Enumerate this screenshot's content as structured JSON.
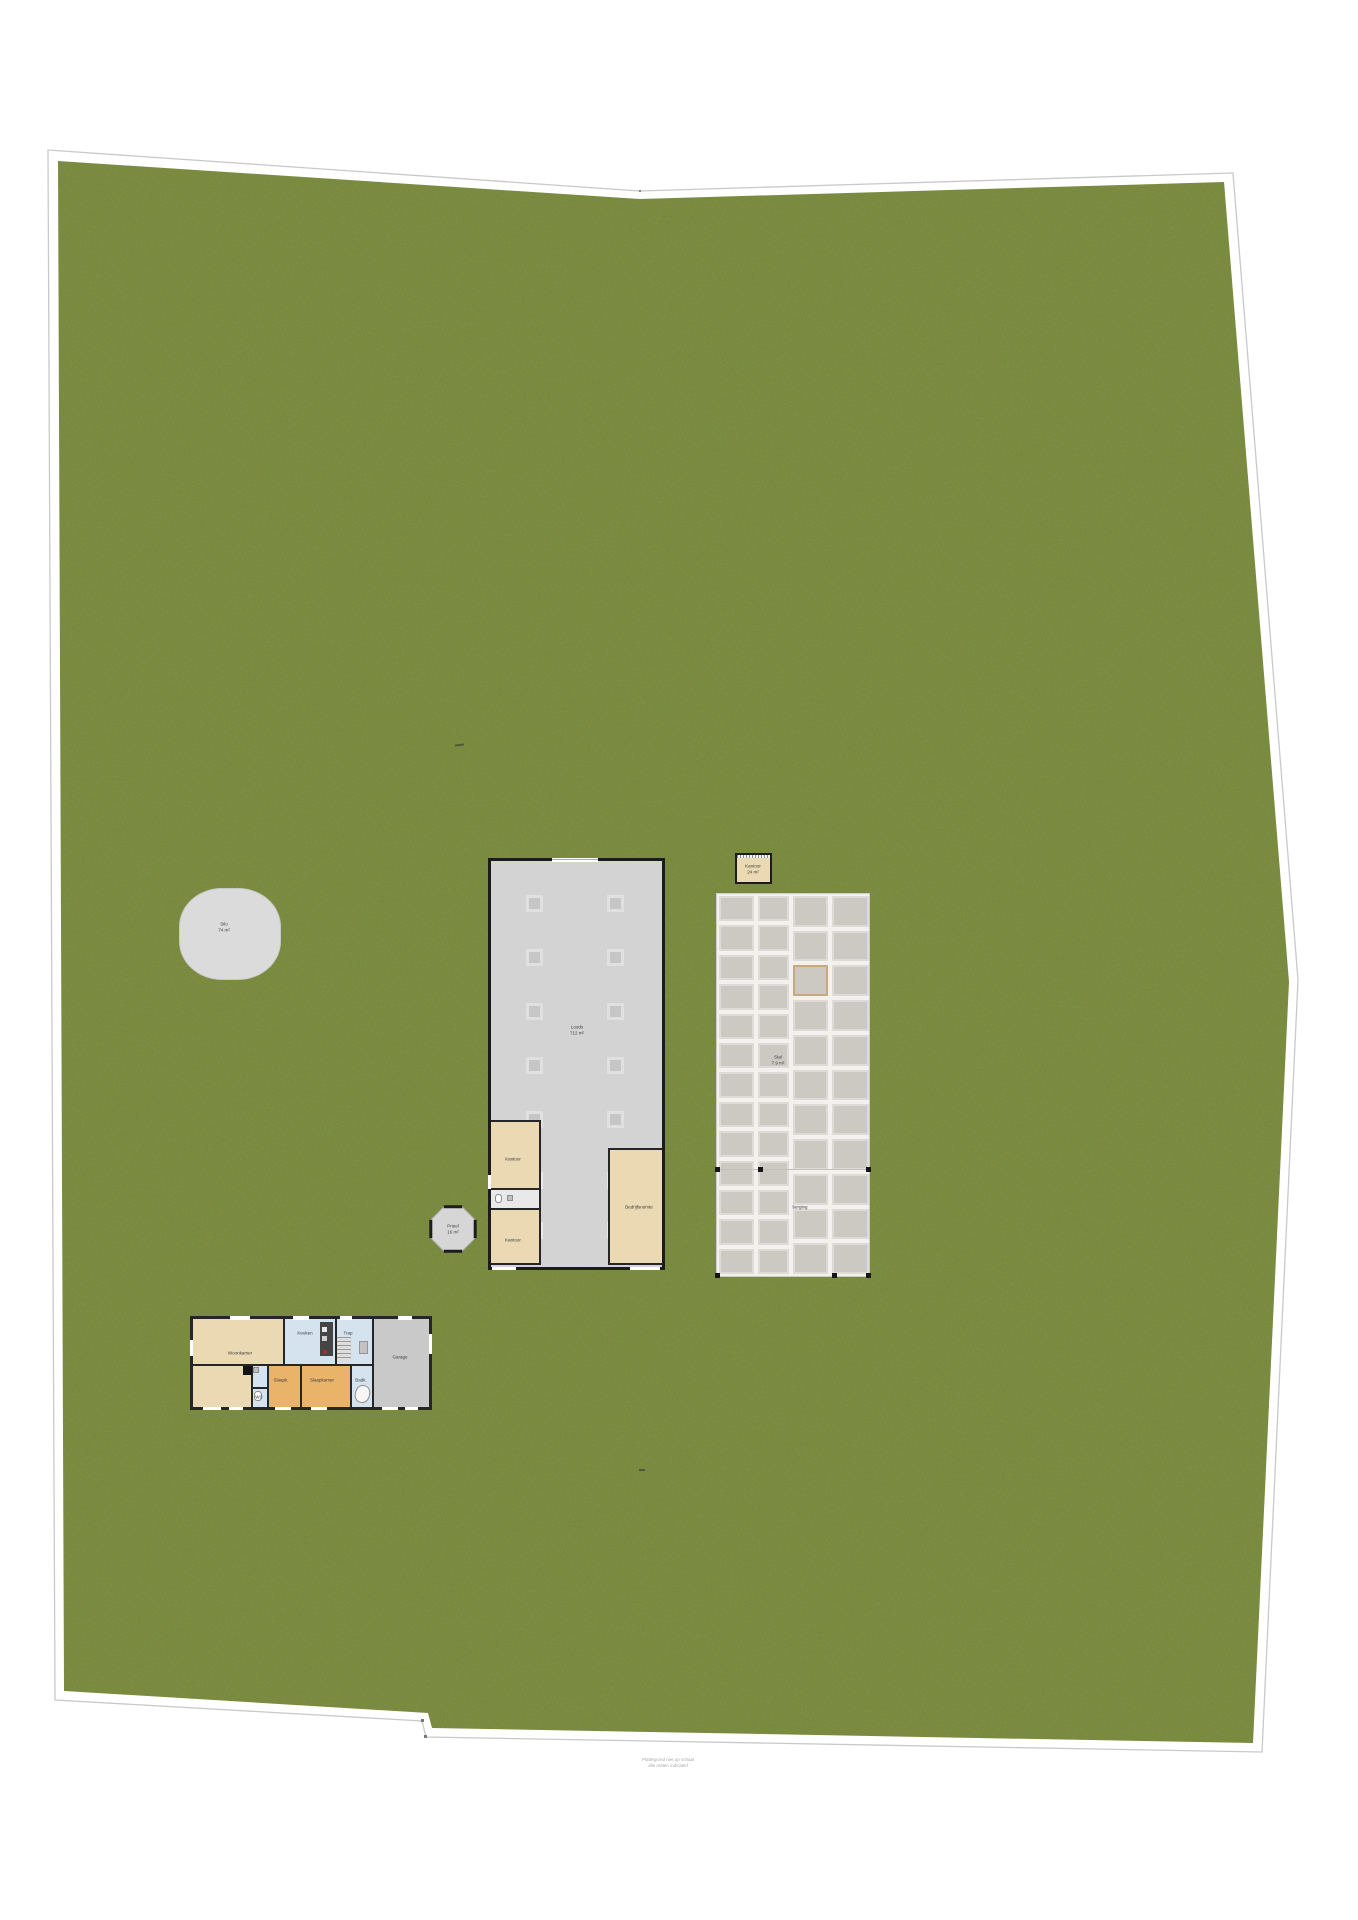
{
  "colors": {
    "grass": "#7e9140",
    "outline": "#c9c9c9",
    "barn_fill": "#d3d3d3",
    "room_tan": "#ead9b2",
    "room_orange": "#e9b469",
    "room_blue": "#d4e3ee",
    "room_gray": "#c9c9c9",
    "stable_cell": "#ccc9c3",
    "stable_cell_border": "#dedbd6",
    "highlight_tan": "#c9a97b",
    "silo_fill": "#dbdbdb"
  },
  "silo": {
    "name": "Silo",
    "area": "74 m²"
  },
  "barn": {
    "name": "Loods",
    "area": "712 m²",
    "rooms": {
      "office1": "Kantoor",
      "office2": "Kantoor",
      "workshop": "Bedrijfsruimte"
    }
  },
  "office": {
    "name": "Kantoor",
    "area": "24 m²"
  },
  "stables": {
    "stall_name": "Stal",
    "stall_area": "7.9 m²",
    "note": "berging",
    "columns": [
      13,
      13,
      11,
      11
    ],
    "highlight": {
      "col": 2,
      "row": 2
    }
  },
  "gazebo": {
    "name": "Prieel",
    "area": "16 m²"
  },
  "house": {
    "rooms": {
      "living": "Woonkamer",
      "kitchen": "Keuken",
      "stairs": "Trap",
      "wc": "WC",
      "bedroom1": "Slaapk.",
      "bedroom2": "Slaapkamer",
      "bath": "Badk.",
      "garage": "Garage"
    }
  },
  "caption": {
    "line1": "Plattegrond niet op schaal",
    "line2": "alle maten indicatief"
  }
}
